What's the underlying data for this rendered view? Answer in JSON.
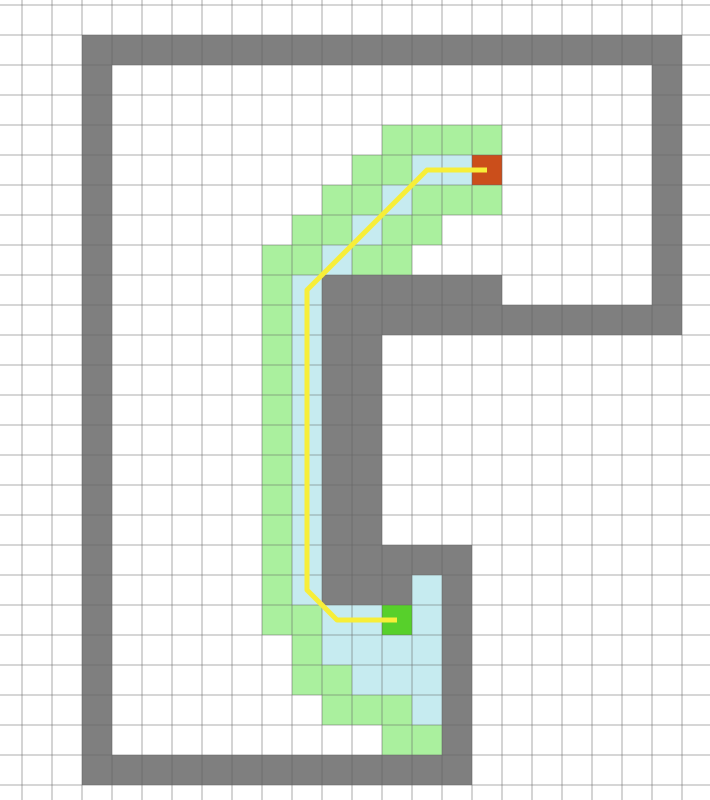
{
  "canvas": {
    "width": 710,
    "height": 800,
    "background": "#ffffff"
  },
  "grid": {
    "cell_size": 30,
    "offset_x": 22,
    "offset_y": 5,
    "line_color": "rgba(100,100,100,0.35)",
    "line_width": 1.6
  },
  "colors": {
    "wall": "#7f7f7f",
    "frontier_green": "#aaf09e",
    "explored_blue": "#c6ebf0",
    "start": "#57d02b",
    "goal": "#cb4e1b",
    "path": "#f7ee38"
  },
  "cells": {
    "wall_runs": [
      {
        "row": 1,
        "from_col": 2,
        "to_col": 21
      },
      {
        "col": 2,
        "from_row": 2,
        "to_row": 25
      },
      {
        "row": 25,
        "from_col": 3,
        "to_col": 14
      },
      {
        "col": 21,
        "from_row": 2,
        "to_row": 10
      },
      {
        "row": 9,
        "from_col": 10,
        "to_col": 15
      },
      {
        "row": 10,
        "from_col": 10,
        "to_col": 20
      },
      {
        "col": 10,
        "from_row": 11,
        "to_row": 17
      },
      {
        "col": 11,
        "from_row": 11,
        "to_row": 17
      },
      {
        "row": 18,
        "from_col": 10,
        "to_col": 14
      },
      {
        "row": 19,
        "from_col": 10,
        "to_col": 12
      },
      {
        "col": 14,
        "from_row": 19,
        "to_row": 24
      }
    ],
    "frontier_green": [
      [
        12,
        4
      ],
      [
        13,
        4
      ],
      [
        14,
        4
      ],
      [
        15,
        4
      ],
      [
        11,
        5
      ],
      [
        12,
        5
      ],
      [
        10,
        6
      ],
      [
        11,
        6
      ],
      [
        13,
        6
      ],
      [
        14,
        6
      ],
      [
        15,
        6
      ],
      [
        9,
        7
      ],
      [
        10,
        7
      ],
      [
        12,
        7
      ],
      [
        13,
        7
      ],
      [
        8,
        8
      ],
      [
        9,
        8
      ],
      [
        11,
        8
      ],
      [
        12,
        8
      ],
      [
        8,
        9
      ],
      [
        8,
        10
      ],
      [
        8,
        11
      ],
      [
        8,
        12
      ],
      [
        8,
        13
      ],
      [
        8,
        14
      ],
      [
        8,
        15
      ],
      [
        8,
        16
      ],
      [
        8,
        17
      ],
      [
        8,
        18
      ],
      [
        8,
        19
      ],
      [
        8,
        20
      ],
      [
        9,
        20
      ],
      [
        9,
        21
      ],
      [
        9,
        22
      ],
      [
        10,
        22
      ],
      [
        10,
        23
      ],
      [
        11,
        23
      ],
      [
        12,
        23
      ],
      [
        12,
        24
      ],
      [
        13,
        24
      ]
    ],
    "explored_blue": [
      [
        13,
        5
      ],
      [
        14,
        5
      ],
      [
        12,
        6
      ],
      [
        11,
        7
      ],
      [
        10,
        8
      ],
      [
        9,
        9
      ],
      [
        9,
        10
      ],
      [
        9,
        11
      ],
      [
        9,
        12
      ],
      [
        9,
        13
      ],
      [
        9,
        14
      ],
      [
        9,
        15
      ],
      [
        9,
        16
      ],
      [
        9,
        17
      ],
      [
        9,
        18
      ],
      [
        9,
        19
      ],
      [
        13,
        19
      ],
      [
        10,
        20
      ],
      [
        11,
        20
      ],
      [
        13,
        20
      ],
      [
        10,
        21
      ],
      [
        11,
        21
      ],
      [
        12,
        21
      ],
      [
        13,
        21
      ],
      [
        11,
        22
      ],
      [
        12,
        22
      ],
      [
        13,
        22
      ],
      [
        13,
        23
      ]
    ],
    "start": [
      12,
      20
    ],
    "goal": [
      15,
      5
    ]
  },
  "path": {
    "waypoints": [
      [
        15,
        5
      ],
      [
        13,
        5
      ],
      [
        9,
        9
      ],
      [
        9,
        19
      ],
      [
        10,
        20
      ],
      [
        12,
        20
      ]
    ],
    "stroke_width": 5
  }
}
